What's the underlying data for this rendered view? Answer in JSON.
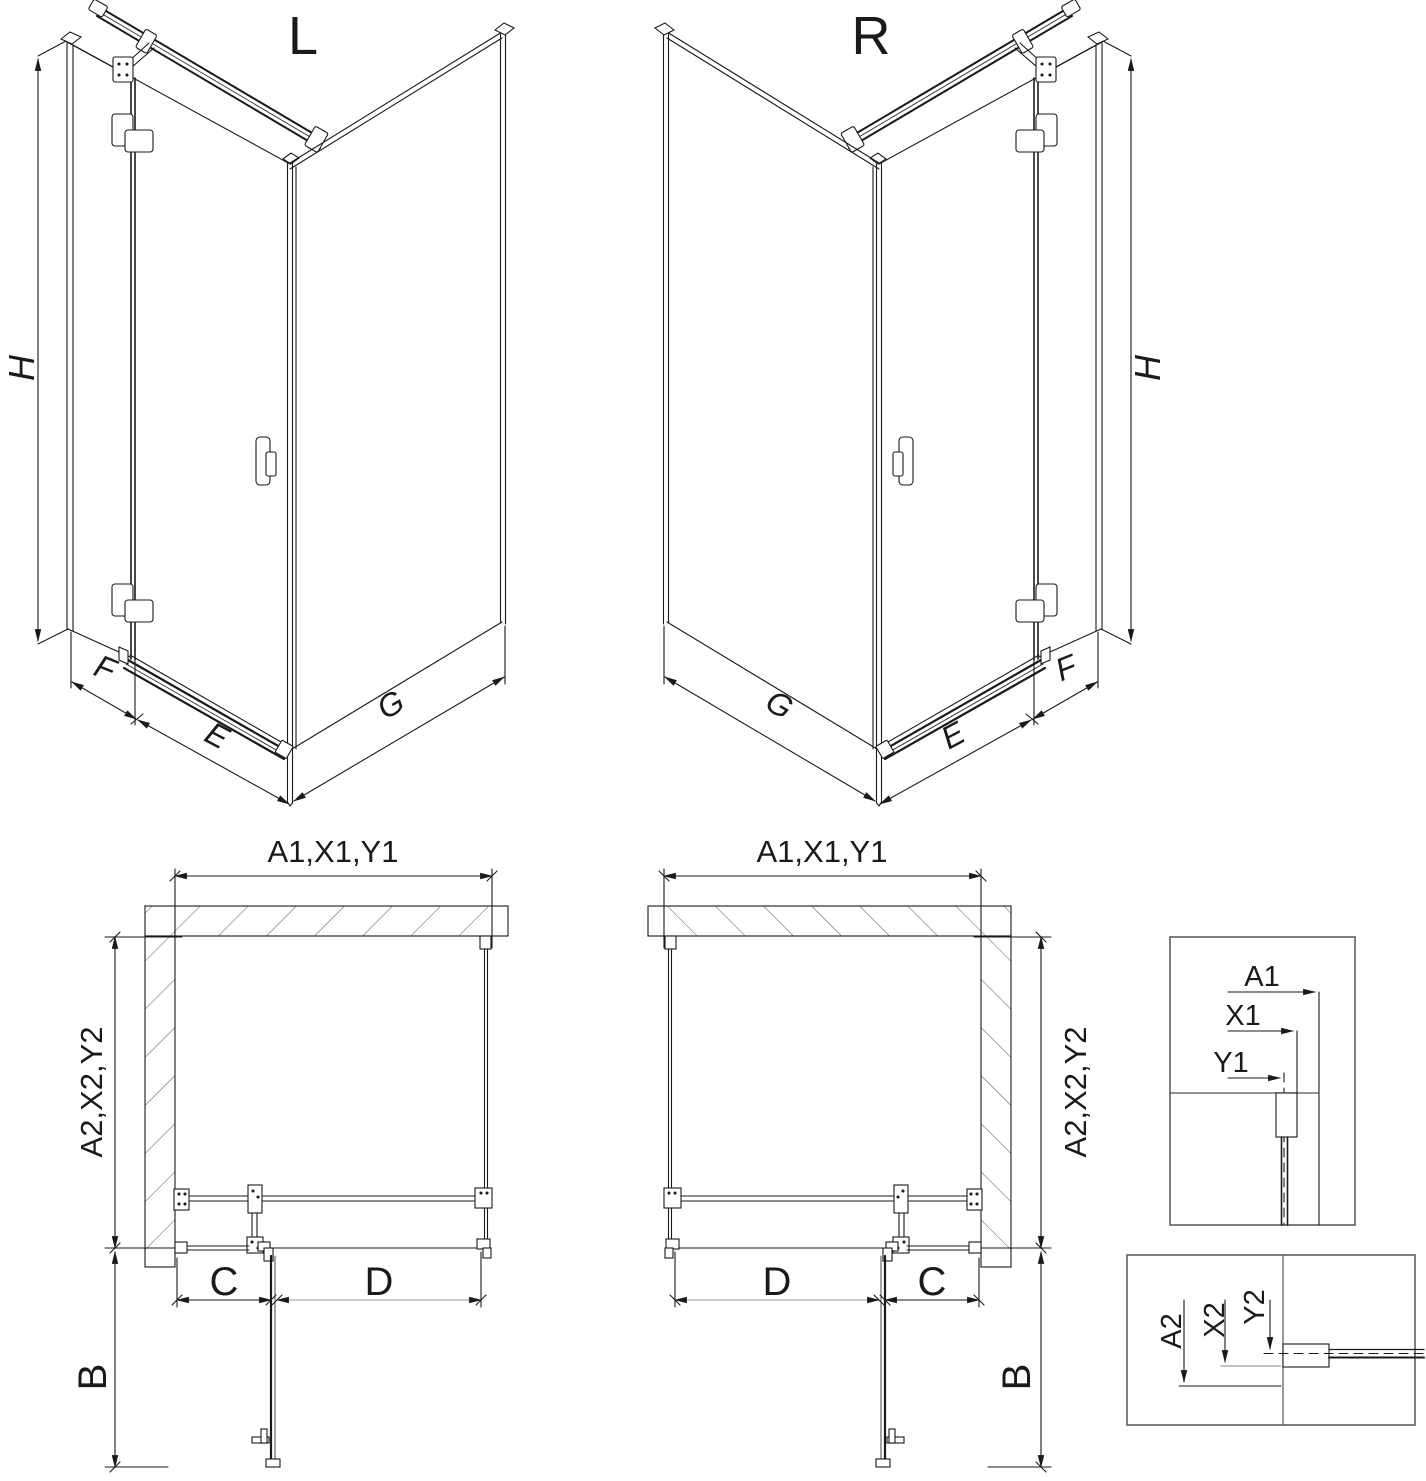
{
  "iso_views": {
    "left": {
      "variant_label": "L",
      "height_dim": "H",
      "side_panel_dim": "F",
      "door_dim": "E",
      "return_panel_dim": "G"
    },
    "right": {
      "variant_label": "R",
      "height_dim": "H",
      "side_panel_dim": "F",
      "door_dim": "E",
      "return_panel_dim": "G"
    }
  },
  "plan_views": {
    "left": {
      "width_dim": "A1,X1,Y1",
      "depth_dim": "A2,X2,Y2",
      "fixed_segment_dim": "C",
      "door_segment_dim": "D",
      "door_swing_dim": "B"
    },
    "right": {
      "width_dim": "A1,X1,Y1",
      "depth_dim": "A2,X2,Y2",
      "fixed_segment_dim": "C",
      "door_segment_dim": "D",
      "door_swing_dim": "B"
    }
  },
  "detail_views": {
    "width_detail": {
      "dims": [
        "A1",
        "X1",
        "Y1"
      ]
    },
    "depth_detail": {
      "dims": [
        "A2",
        "X2",
        "Y2"
      ]
    }
  },
  "colors": {
    "line": "#1a1a1a",
    "frame": "#555555",
    "light_line": "#999999",
    "background": "#ffffff"
  }
}
